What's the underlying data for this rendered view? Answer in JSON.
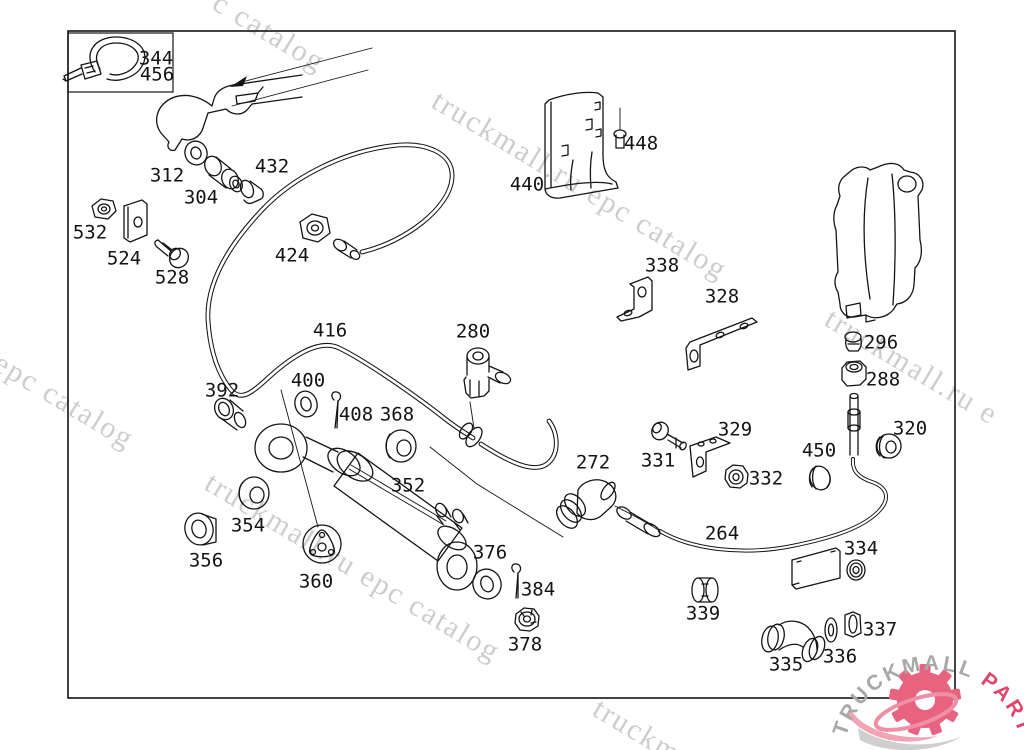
{
  "diagram": {
    "type": "exploded-parts-diagram",
    "subject": "truck hydraulic steering / clutch line assembly",
    "frame": "single rectangular border with inset legend box (cable tie)"
  },
  "parts": {
    "labels": [
      "344",
      "456",
      "312",
      "304",
      "432",
      "532",
      "524",
      "528",
      "424",
      "440",
      "448",
      "416",
      "280",
      "338",
      "328",
      "296",
      "288",
      "392",
      "400",
      "408",
      "368",
      "272",
      "329",
      "331",
      "332",
      "450",
      "320",
      "352",
      "354",
      "356",
      "360",
      "376",
      "384",
      "378",
      "264",
      "334",
      "339",
      "335",
      "336",
      "337"
    ]
  },
  "watermarks": {
    "full": "truckmall.ru epc catalog",
    "fragments": [
      "c catalog",
      "truckmall.ru epc catalog",
      "l epc catalog",
      "truckmall.ru e",
      "truckmall.ru epc catalog",
      "truckm"
    ]
  },
  "logo": {
    "brand": "TRUCKMALL",
    "suffix": "PARTS",
    "brand_color": "#a8a8a8",
    "suffix_color": "#e2456b",
    "gear_color": "#e8637f"
  },
  "colors": {
    "background": "#ffffff",
    "line": "#141414",
    "watermark": "#cdcdcd"
  }
}
